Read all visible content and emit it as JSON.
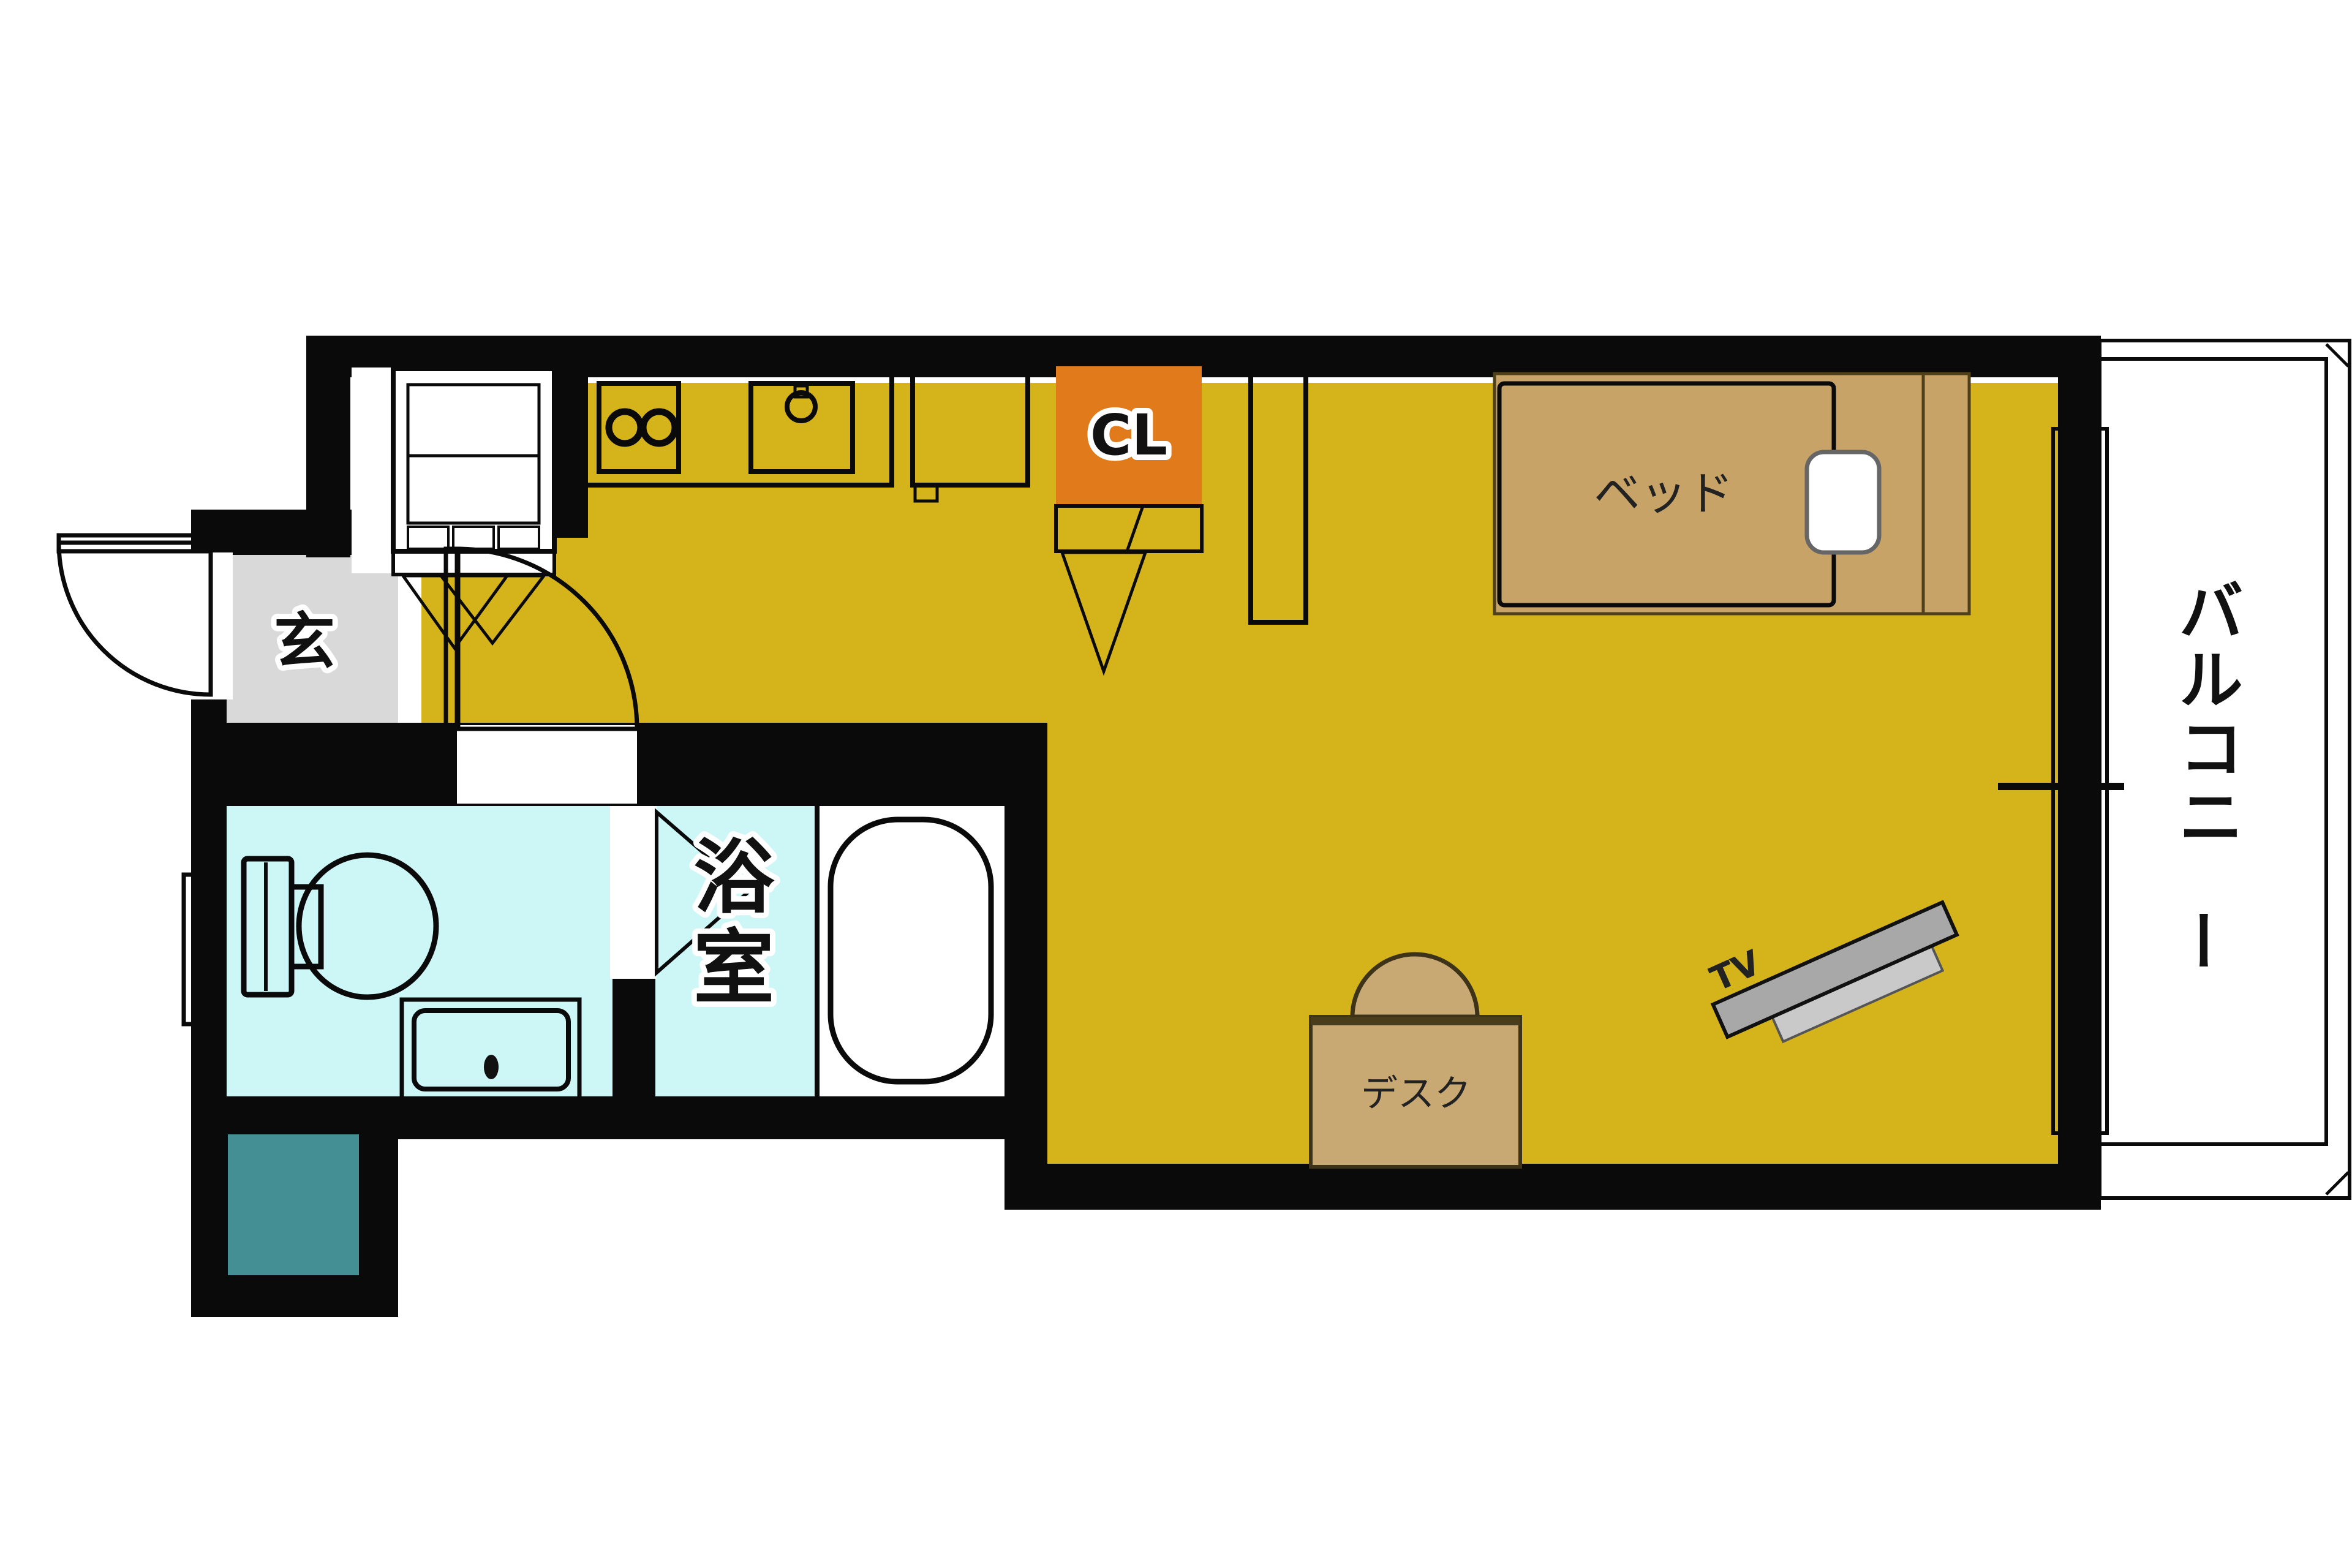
{
  "labels": {
    "entrance": "玄",
    "closet": "CL",
    "bed": "ベッド",
    "balcony": "バルコニー",
    "bathroom": "浴室",
    "desk": "デスク",
    "tv": "TV"
  },
  "colors": {
    "wall": "#0a0a0a",
    "floor_yellow": "#d4b41a",
    "entrance_gray": "#d9d9d9",
    "balcony_gray": "#dcdcdc",
    "wet_area_cyan": "#cdf6f6",
    "washer_teal": "#448f93",
    "closet_orange": "#e07a1a",
    "bed_frame_tan": "#c8a368",
    "desk_tan": "#c8a873",
    "shelf_blue": "#dbe9fa",
    "appliance_gray": "#c6c6c6",
    "tv_gray": "#a8a8a8",
    "tv_stand_gray": "#c9c9c9",
    "sink_gray": "#e6e6e6"
  }
}
